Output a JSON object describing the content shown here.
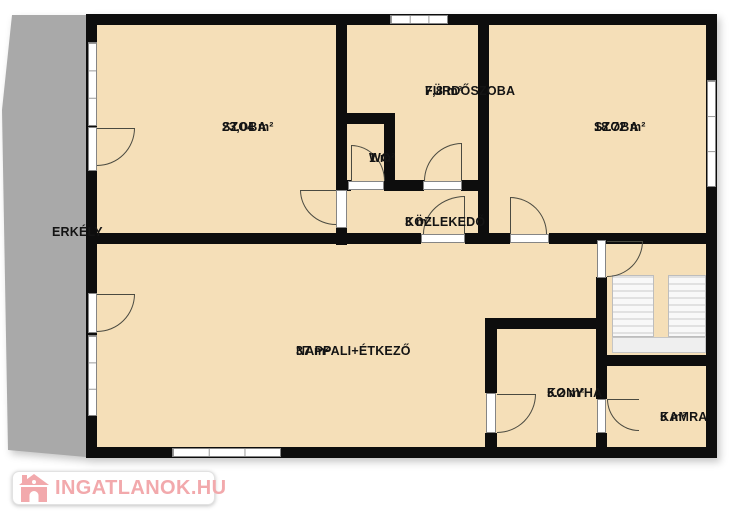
{
  "colors": {
    "room_fill": "#f5dfb8",
    "wall": "#0d0d0d",
    "balcony": "#a9a9a9",
    "arc": "#4a4a40",
    "logo_pink": "#f2a9ac"
  },
  "watermark": {
    "text": "INGATLANOK.HU"
  },
  "rooms": [
    {
      "id": "erkely",
      "name": "ERKÉLY",
      "area": "",
      "cx": 52,
      "cy": 225
    },
    {
      "id": "szoba-left",
      "name": "SZOBA",
      "area": "23,04 m²",
      "cx": 222,
      "cy": 120
    },
    {
      "id": "furdoszoba",
      "name": "FÜRDŐSZOBA",
      "area": "7,8 m²",
      "cx": 425,
      "cy": 84
    },
    {
      "id": "wc",
      "name": "WC",
      "area": "1 m²",
      "cx": 369,
      "cy": 151
    },
    {
      "id": "szoba-right",
      "name": "SZOBA",
      "area": "18.72 m²",
      "cx": 594,
      "cy": 120
    },
    {
      "id": "kozlekedo",
      "name": "KÖZLEKEDŐ",
      "area": "3 m²",
      "cx": 405,
      "cy": 215
    },
    {
      "id": "nappali",
      "name": "NAPPALI+ÉTKEZŐ",
      "area": "37 m²",
      "cx": 296,
      "cy": 344
    },
    {
      "id": "konyha",
      "name": "KONYHA",
      "area": "5.2 m²",
      "cx": 547,
      "cy": 386
    },
    {
      "id": "kamra",
      "name": "KAMRA",
      "area": "5 m²",
      "cx": 660,
      "cy": 410
    }
  ],
  "plan": {
    "interior": {
      "x": 97,
      "y": 25,
      "w": 609,
      "h": 422
    },
    "balcony": {
      "x": 0,
      "y": 13,
      "w": 97,
      "h": 445,
      "points": [
        [
          12,
          2
        ],
        [
          97,
          2
        ],
        [
          97,
          445
        ],
        [
          8,
          437
        ],
        [
          2,
          97
        ]
      ]
    },
    "walls": [
      {
        "x": 86,
        "y": 14,
        "w": 631,
        "h": 11
      },
      {
        "x": 86,
        "y": 447,
        "w": 631,
        "h": 11
      },
      {
        "x": 86,
        "y": 14,
        "w": 11,
        "h": 444
      },
      {
        "x": 706,
        "y": 14,
        "w": 11,
        "h": 444
      },
      {
        "x": 336,
        "y": 14,
        "w": 11,
        "h": 176
      },
      {
        "x": 336,
        "y": 228,
        "w": 11,
        "h": 17
      },
      {
        "x": 384,
        "y": 113,
        "w": 11,
        "h": 78
      },
      {
        "x": 336,
        "y": 113,
        "w": 59,
        "h": 11
      },
      {
        "x": 336,
        "y": 180,
        "w": 15,
        "h": 11
      },
      {
        "x": 386,
        "y": 180,
        "w": 38,
        "h": 11
      },
      {
        "x": 461,
        "y": 180,
        "w": 28,
        "h": 11
      },
      {
        "x": 478,
        "y": 14,
        "w": 11,
        "h": 230
      },
      {
        "x": 86,
        "y": 233,
        "w": 335,
        "h": 11
      },
      {
        "x": 465,
        "y": 233,
        "w": 45,
        "h": 11
      },
      {
        "x": 549,
        "y": 233,
        "w": 168,
        "h": 11
      },
      {
        "x": 596,
        "y": 277,
        "w": 11,
        "h": 122
      },
      {
        "x": 596,
        "y": 433,
        "w": 11,
        "h": 25
      },
      {
        "x": 485,
        "y": 318,
        "w": 12,
        "h": 75
      },
      {
        "x": 485,
        "y": 433,
        "w": 12,
        "h": 25
      },
      {
        "x": 485,
        "y": 318,
        "w": 122,
        "h": 11
      },
      {
        "x": 596,
        "y": 355,
        "w": 121,
        "h": 11
      }
    ],
    "windows": [
      {
        "x": 390,
        "y": 15,
        "w": 58,
        "h": 9
      },
      {
        "x": 707,
        "y": 80,
        "w": 9,
        "h": 107
      },
      {
        "x": 88,
        "y": 42,
        "w": 9,
        "h": 84
      },
      {
        "x": 88,
        "y": 335,
        "w": 9,
        "h": 81
      },
      {
        "x": 172,
        "y": 448,
        "w": 109,
        "h": 9
      }
    ],
    "thresholds": [
      {
        "x": 88,
        "y": 127,
        "w": 9,
        "h": 44,
        "name": "balcony-door-szoba"
      },
      {
        "x": 88,
        "y": 293,
        "w": 9,
        "h": 40,
        "name": "balcony-door-nappali"
      },
      {
        "x": 348,
        "y": 181,
        "w": 36,
        "h": 9,
        "name": "wc-door"
      },
      {
        "x": 423,
        "y": 181,
        "w": 39,
        "h": 9,
        "name": "bathroom-door"
      },
      {
        "x": 336,
        "y": 190,
        "w": 11,
        "h": 38,
        "name": "szoba-left-door"
      },
      {
        "x": 421,
        "y": 234,
        "w": 44,
        "h": 9,
        "name": "hall-door"
      },
      {
        "x": 510,
        "y": 234,
        "w": 39,
        "h": 9,
        "name": "szoba-right-door"
      },
      {
        "x": 597,
        "y": 240,
        "w": 9,
        "h": 38,
        "name": "entrance-door"
      },
      {
        "x": 486,
        "y": 393,
        "w": 10,
        "h": 40,
        "name": "kitchen-door"
      },
      {
        "x": 597,
        "y": 399,
        "w": 9,
        "h": 34,
        "name": "pantry-door"
      }
    ],
    "arcs": [
      {
        "x": 97,
        "y": 128,
        "w": 38,
        "h": 38,
        "corner": "br",
        "leaf": "top",
        "name": "balcony-door-arc-szoba"
      },
      {
        "x": 97,
        "y": 294,
        "w": 38,
        "h": 38,
        "corner": "br",
        "leaf": "top",
        "name": "balcony-door-arc-nappali"
      },
      {
        "x": 351,
        "y": 145,
        "w": 34,
        "h": 36,
        "corner": "tr",
        "leaf": "left",
        "name": "wc-door-arc"
      },
      {
        "x": 424,
        "y": 143,
        "w": 38,
        "h": 38,
        "corner": "tl",
        "leaf": "right",
        "name": "bathroom-door-arc"
      },
      {
        "x": 300,
        "y": 190,
        "w": 36,
        "h": 35,
        "corner": "bl",
        "leaf": "top",
        "name": "szoba-left-door-arc"
      },
      {
        "x": 423,
        "y": 196,
        "w": 42,
        "h": 38,
        "corner": "tl",
        "leaf": "right",
        "name": "hall-door-arc"
      },
      {
        "x": 510,
        "y": 197,
        "w": 37,
        "h": 37,
        "corner": "tr",
        "leaf": "left",
        "name": "szoba-right-door-arc"
      },
      {
        "x": 607,
        "y": 241,
        "w": 36,
        "h": 36,
        "corner": "br",
        "leaf": "top",
        "name": "entrance-door-arc"
      },
      {
        "x": 497,
        "y": 394,
        "w": 39,
        "h": 39,
        "corner": "br",
        "leaf": "top",
        "name": "kitchen-door-arc"
      },
      {
        "x": 607,
        "y": 399,
        "w": 32,
        "h": 32,
        "corner": "bl",
        "leaf": "top",
        "name": "pantry-door-arc"
      }
    ],
    "stairs": {
      "x": 612,
      "y": 275,
      "w": 94,
      "h": 78,
      "flights": [
        {
          "x": 0,
          "y": 0,
          "w": 42,
          "h": 62
        },
        {
          "x": 56,
          "y": 0,
          "w": 38,
          "h": 62
        }
      ],
      "gap": {
        "x": 42,
        "y": 0,
        "w": 14,
        "h": 62
      },
      "landing": {
        "x": 0,
        "y": 62,
        "w": 94,
        "h": 16
      }
    }
  }
}
